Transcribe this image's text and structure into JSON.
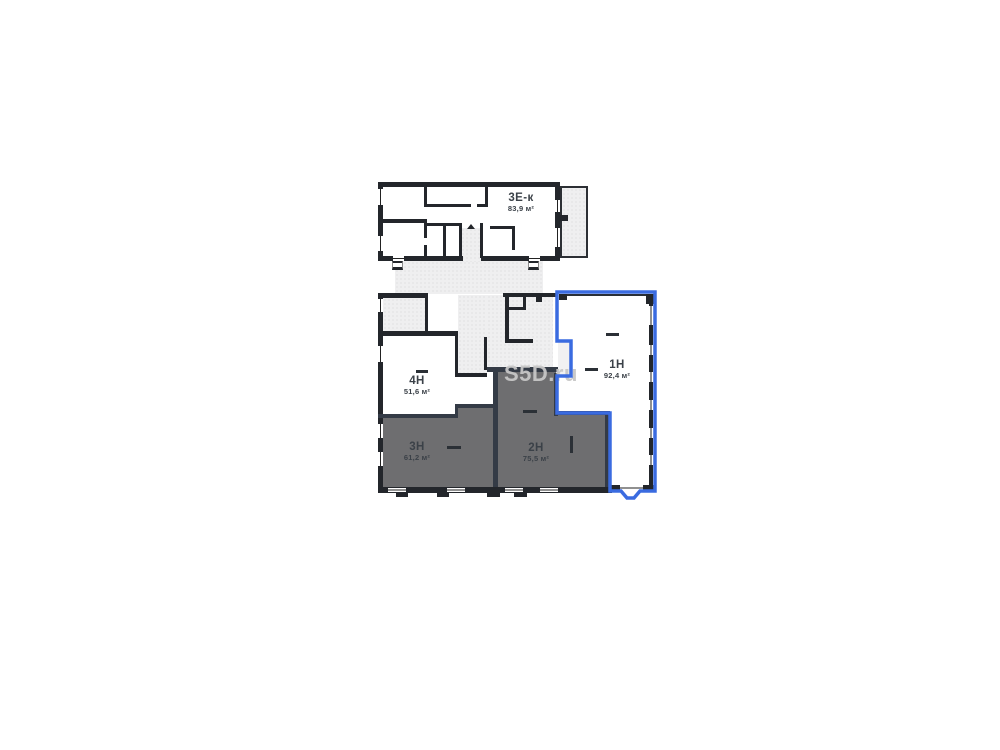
{
  "watermark": "S5D.ru",
  "units": [
    {
      "id": "3ek",
      "name": "3Е-к",
      "area": "83,9 м²",
      "fill": "white",
      "highlighted": false
    },
    {
      "id": "4n",
      "name": "4Н",
      "area": "51,6 м²",
      "fill": "white",
      "highlighted": false
    },
    {
      "id": "3n",
      "name": "3Н",
      "area": "61,2 м²",
      "fill": "dark",
      "highlighted": false
    },
    {
      "id": "2n",
      "name": "2Н",
      "area": "75,5 м²",
      "fill": "dark",
      "highlighted": false
    },
    {
      "id": "1n",
      "name": "1Н",
      "area": "92,4 м²",
      "fill": "white",
      "highlighted": true
    }
  ],
  "colors": {
    "highlight": "#3a6be0",
    "wall": "#23262b",
    "dark_room": "#6e6e70",
    "hatch": "#efeff0",
    "label": "#3b4148",
    "watermark": "#c7c7c7"
  }
}
